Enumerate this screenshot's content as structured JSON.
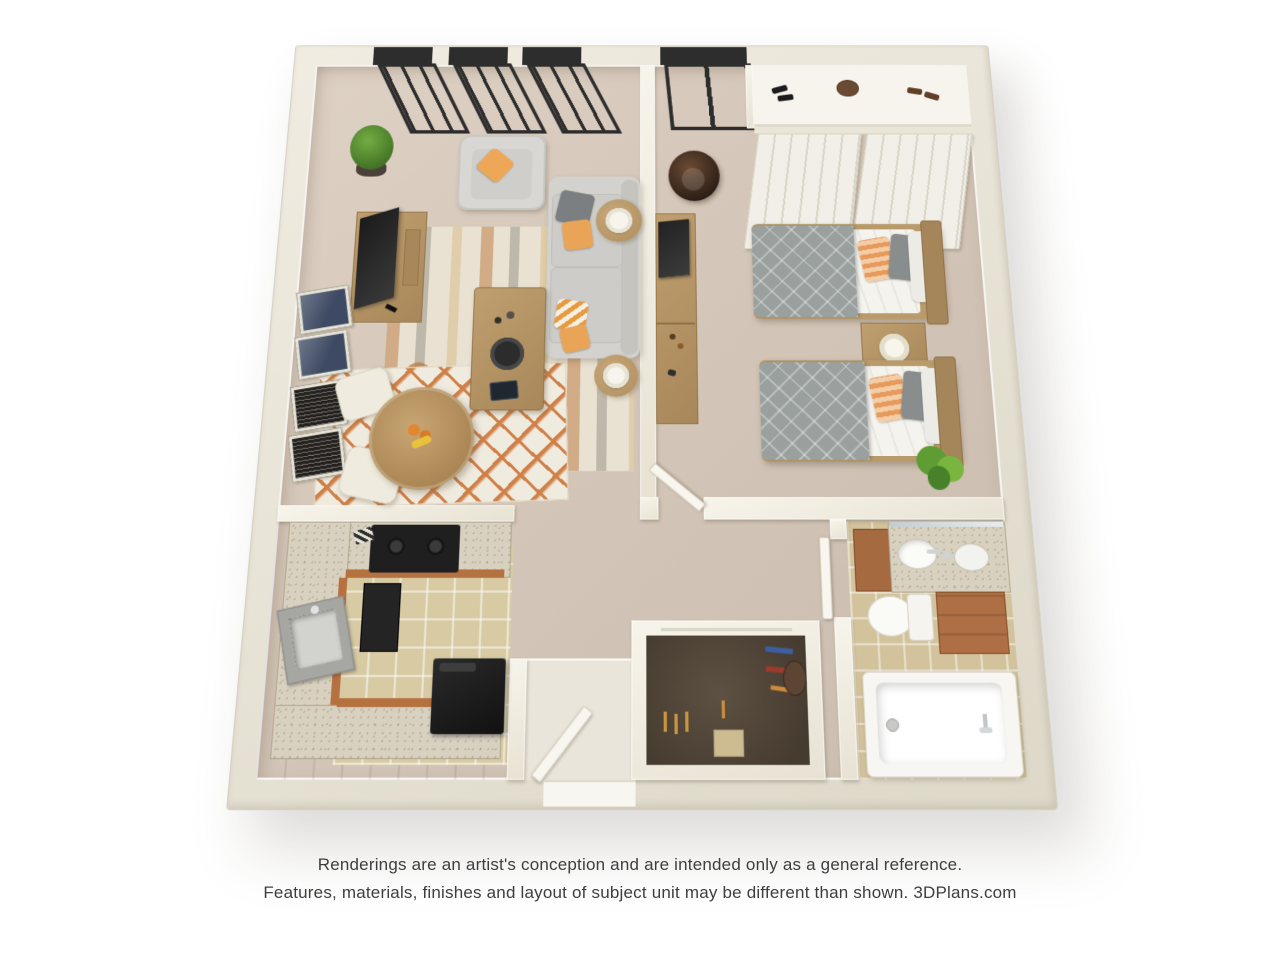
{
  "image": {
    "type": "3d-floor-plan-rendering",
    "description": "Top-down 3D rendering of a one-bedroom, one-bath apartment with open living/dining room, U-shaped kitchen, bedroom with two twin beds, walk-in closet and bathroom"
  },
  "disclaimer": {
    "line1": "Renderings are an artist's conception and are intended only as a general reference.",
    "line2": "Features, materials, finishes and layout of subject unit may be different than shown.",
    "brand": "3DPlans.com"
  },
  "palette": {
    "page_background": "#ffffff",
    "wall": "#eae5d8",
    "carpet": "#d5c7b9",
    "kitchen_cabinet_terracotta": "#bd7748",
    "kitchen_tile": "#d8cba4",
    "bathroom_tile": "#d3c39c",
    "closet_floor_brown": "#52463a",
    "accent_orange": "#e9a458",
    "bedding_gray": "#9aa09f",
    "furniture_wood": "#b29167",
    "window_frame": "#2d2d2d",
    "fixture_white": "#f7f6f1"
  },
  "floor_plan": {
    "rooms": [
      {
        "name": "living-dining-room",
        "contents": [
          "sofa",
          "armchair",
          "coffee-table",
          "striped-area-rug",
          "tv-console",
          "flat-tv",
          "four-wall-art-frames",
          "two-side-tables",
          "two-table-lamps",
          "round-dining-table",
          "two-dining-chairs",
          "diamond-pattern-rug",
          "potted-plant",
          "three-windows",
          "fruit-bowl"
        ]
      },
      {
        "name": "bedroom",
        "contents": [
          "twin-bed",
          "twin-bed",
          "nightstand",
          "table-lamp",
          "dresser-desk",
          "tv",
          "lounge-chair",
          "sliding-door-closet",
          "closet-shelf-with-shoes-and-bags",
          "window",
          "plant",
          "door"
        ]
      },
      {
        "name": "kitchen",
        "contents": [
          "u-shaped-counter",
          "cooktop",
          "sink",
          "black-appliance",
          "wall-oven",
          "tile-floor"
        ]
      },
      {
        "name": "bathroom",
        "contents": [
          "vanity-with-sink",
          "mirror",
          "toilet",
          "storage-cabinet",
          "bathtub",
          "door"
        ]
      },
      {
        "name": "walk-in-closet",
        "contents": [
          "hanging-clothes",
          "bag",
          "storage-box"
        ]
      },
      {
        "name": "entry",
        "contents": [
          "entry-door"
        ]
      }
    ]
  }
}
